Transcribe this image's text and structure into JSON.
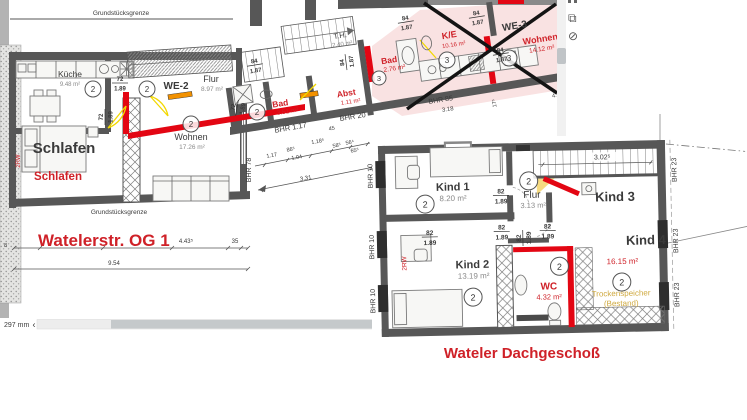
{
  "window": {
    "scroll_label": "297 mm",
    "scroll_arrow": "‹"
  },
  "toolbar_icons": [
    "cropped-icon",
    "copy-icon",
    "status-circle-icon"
  ],
  "plan1": {
    "title": "Watelerstr. OG 1",
    "boundary_top": "Grundstücksgrenze",
    "boundary_bottom": "Grundstücksgrenze",
    "we2_label": "WE-2",
    "we3_label": "WE-3",
    "rooms": {
      "kueche": {
        "name": "Küche",
        "area": "9.48 m²",
        "unit": "2"
      },
      "flur": {
        "name": "Flur",
        "area": "8.97 m²",
        "unit": "2"
      },
      "schlafen": {
        "name": "Schlafen",
        "name_red": "Schlafen"
      },
      "wohnen": {
        "name": "Wohnen",
        "area": "17.26 m²",
        "unit": "2"
      },
      "bad": {
        "name": "Bad",
        "area": "3.51 m²",
        "unit": "2"
      },
      "abst": {
        "name": "Abst",
        "area": "1.11 m²"
      },
      "th": {
        "name": "T.H.",
        "area": "2.40 m²"
      },
      "bad2": {
        "name": "Bad",
        "area": "2.76 m²",
        "unit": "3"
      },
      "ke": {
        "name": "K/E",
        "area": "10.16 m²",
        "unit": "3"
      },
      "wohnen3": {
        "name": "Wohnen",
        "area": "14.12 m²",
        "unit": "3"
      }
    },
    "annotations": {
      "rw": "2RW",
      "left_tick": "8"
    },
    "dims": {
      "f72": {
        "top": "72",
        "bottom": "1.89"
      },
      "f84": {
        "top": "84",
        "bottom": "1.87"
      },
      "bhr78": "BHR 78",
      "bhr117": "BHR 1.17",
      "bhr20": "BHR 20",
      "bhr85": "BHR 85",
      "c117": "1.17",
      "c865": "86⁵",
      "c104": "1.04",
      "c1185": "1.18⁵",
      "c45": "45",
      "c585": "58⁵",
      "c564": "56⁴",
      "c655": "65⁵",
      "c331": "3.31",
      "d318": "3.18",
      "d175": "17⁵",
      "d45": "4.5",
      "w4435": "4.43⁵",
      "w35": "35",
      "w954": "9.54"
    }
  },
  "plan2": {
    "title": "Wateler Dachgeschoß",
    "rooms": {
      "kind1": {
        "name": "Kind 1",
        "area": "8.20 m²",
        "unit": "2"
      },
      "kind2": {
        "name": "Kind 2",
        "area": "13.19 m²",
        "unit": "2"
      },
      "kind3": {
        "name": "Kind 3"
      },
      "kind4": {
        "name": "Kind 4"
      },
      "flur": {
        "name": "Flur",
        "area": "3.13 m²",
        "unit": "2"
      },
      "wc": {
        "name": "WC",
        "area": "4.32 m²",
        "unit": "2"
      },
      "speicher": {
        "area": "16.15 m²",
        "unit": "2",
        "line1": "Trockenspeicher",
        "line2": "(Bestand)"
      }
    },
    "annotations": {
      "rw": "2RW"
    },
    "dims": {
      "f82": {
        "top": "82",
        "bottom": "1.89"
      },
      "bhr10": "BHR 10",
      "bhr23": "BHR 23",
      "stair": "3.02⁵"
    }
  }
}
